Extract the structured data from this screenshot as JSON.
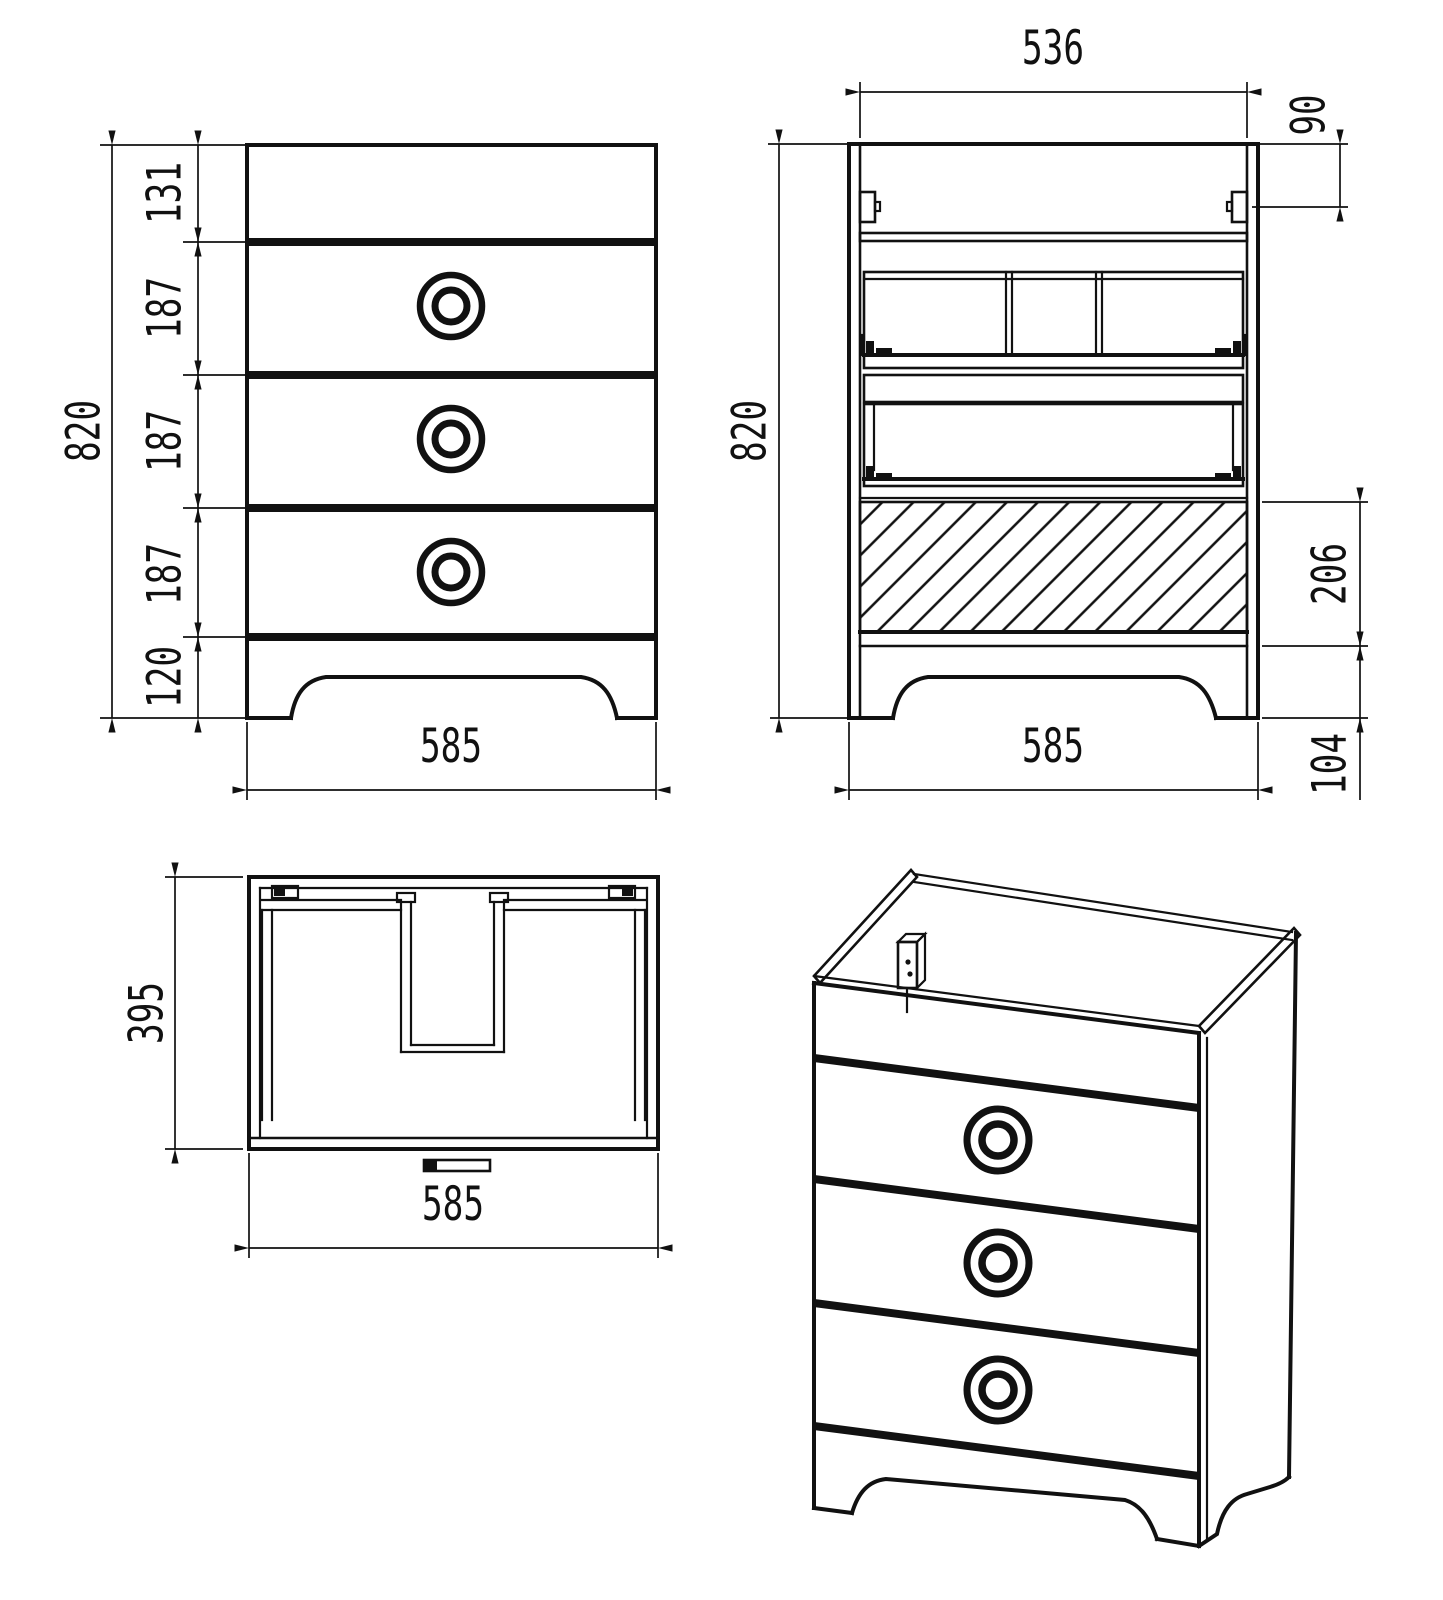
{
  "drawing": {
    "type": "furniture-technical-drawing",
    "colors": {
      "background": "#ffffff",
      "line": "#111111"
    },
    "views": {
      "front": {
        "label": "front-view",
        "height_total": "820",
        "segments": [
          "131",
          "187",
          "187",
          "187",
          "120"
        ],
        "width": "585"
      },
      "back": {
        "label": "back-open-view",
        "inner_width": "536",
        "hanger_offset": "90",
        "height_total": "820",
        "plinth_zone": "206",
        "width": "585",
        "foot_height": "104"
      },
      "plan": {
        "label": "top-view",
        "depth": "395",
        "width": "585"
      },
      "iso": {
        "label": "isometric-view"
      }
    }
  }
}
